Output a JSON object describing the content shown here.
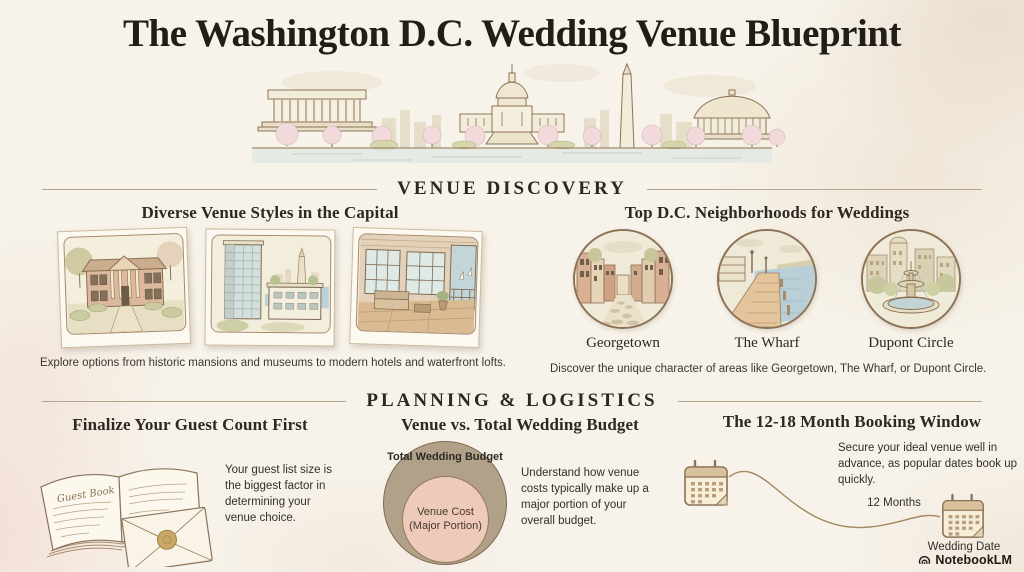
{
  "title": "The Washington D.C. Wedding Venue Blueprint",
  "skyline_icon": "dc-skyline-illustration",
  "colors": {
    "background": "#f7f3ea",
    "rule": "#b5a58d",
    "budget_outer": "#b1a188",
    "budget_inner": "#edcaba"
  },
  "sections": {
    "venue_discovery": {
      "label": "VENUE DISCOVERY",
      "venue_styles": {
        "heading": "Diverse Venue Styles in the Capital",
        "photos": [
          {
            "icon": "historic-mansion-illustration"
          },
          {
            "icon": "modern-hotel-illustration"
          },
          {
            "icon": "waterfront-loft-illustration"
          }
        ],
        "caption": "Explore options from historic mansions and museums to modern hotels and waterfront lofts."
      },
      "neighborhoods": {
        "heading": "Top D.C. Neighborhoods for Weddings",
        "items": [
          {
            "label": "Georgetown",
            "icon": "georgetown-street-illustration"
          },
          {
            "label": "The Wharf",
            "icon": "wharf-boardwalk-illustration"
          },
          {
            "label": "Dupont Circle",
            "icon": "dupont-fountain-illustration"
          }
        ],
        "caption": "Discover the unique character of areas like Georgetown, The Wharf, or Dupont Circle."
      }
    },
    "planning_logistics": {
      "label": "PLANNING & LOGISTICS",
      "guest_count": {
        "heading": "Finalize Your Guest Count First",
        "book_label": "Guest Book",
        "illustration": "guest-book-and-envelope-illustration",
        "body": "Your guest list size is the biggest factor in determining your venue choice."
      },
      "budget": {
        "heading": "Venue vs. Total Wedding Budget",
        "outer_label": "Total Wedding Budget",
        "inner_label": "Venue Cost (Major Portion)",
        "body": "Understand how venue costs typically make up a major portion of your overall budget."
      },
      "booking": {
        "heading": "The 12-18 Month Booking Window",
        "body": "Secure your ideal venue well in advance, as popular dates book up quickly.",
        "start_icon": "calendar-icon",
        "milestone_label": "12 Months",
        "end_icon": "calendar-icon",
        "end_label": "Wedding Date"
      }
    }
  },
  "footer": {
    "brand": "NotebookLM",
    "icon": "notebooklm-logo-icon"
  }
}
